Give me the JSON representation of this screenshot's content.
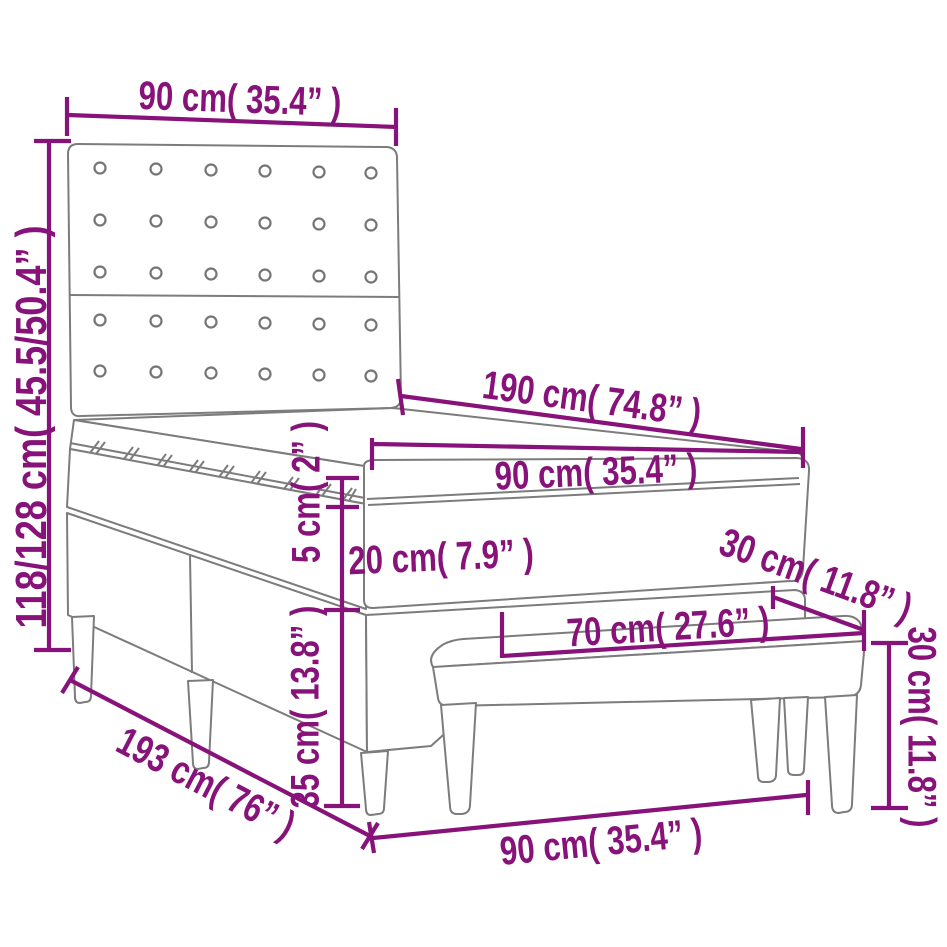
{
  "diagram": {
    "type": "product-dimension-diagram",
    "subject": "Box spring bed with button-tufted headboard, mattress topper and upholstered bench",
    "background_color": "#ffffff",
    "dimension_color": "#87137a",
    "outline_color": "#7c7c7c",
    "units": "cm and inches",
    "dimensions": {
      "headboard_width": {
        "label": "90 cm( 35.4” )",
        "cm": 90,
        "inches": 35.4
      },
      "overall_height": {
        "label": "118/128 cm( 45.5/50.4” )",
        "cm_min": 118,
        "cm_max": 128
      },
      "bed_length": {
        "label": "190 cm( 74.8” )",
        "cm": 190,
        "inches": 74.8
      },
      "bed_width": {
        "label": "90 cm( 35.4” )",
        "cm": 90,
        "inches": 35.4
      },
      "topper_thickness": {
        "label": "5 cm( 2” )",
        "cm": 5,
        "inches": 2
      },
      "mattress_thickness": {
        "label": "20 cm( 7.9” )",
        "cm": 20,
        "inches": 7.9
      },
      "base_height": {
        "label": "35 cm( 13.8” )",
        "cm": 35,
        "inches": 13.8
      },
      "overall_length": {
        "label": "193 cm( 76” )",
        "cm": 193,
        "inches": 76
      },
      "bed_width_floor": {
        "label": "90 cm( 35.4” )",
        "cm": 90,
        "inches": 35.4
      },
      "bench_depth": {
        "label": "30 cm( 11.8” )",
        "cm": 30,
        "inches": 11.8
      },
      "bench_width": {
        "label": "70 cm( 27.6” )",
        "cm": 70,
        "inches": 27.6
      },
      "bench_height": {
        "label": "30 cm( 11.8” )",
        "cm": 30,
        "inches": 11.8
      }
    }
  }
}
